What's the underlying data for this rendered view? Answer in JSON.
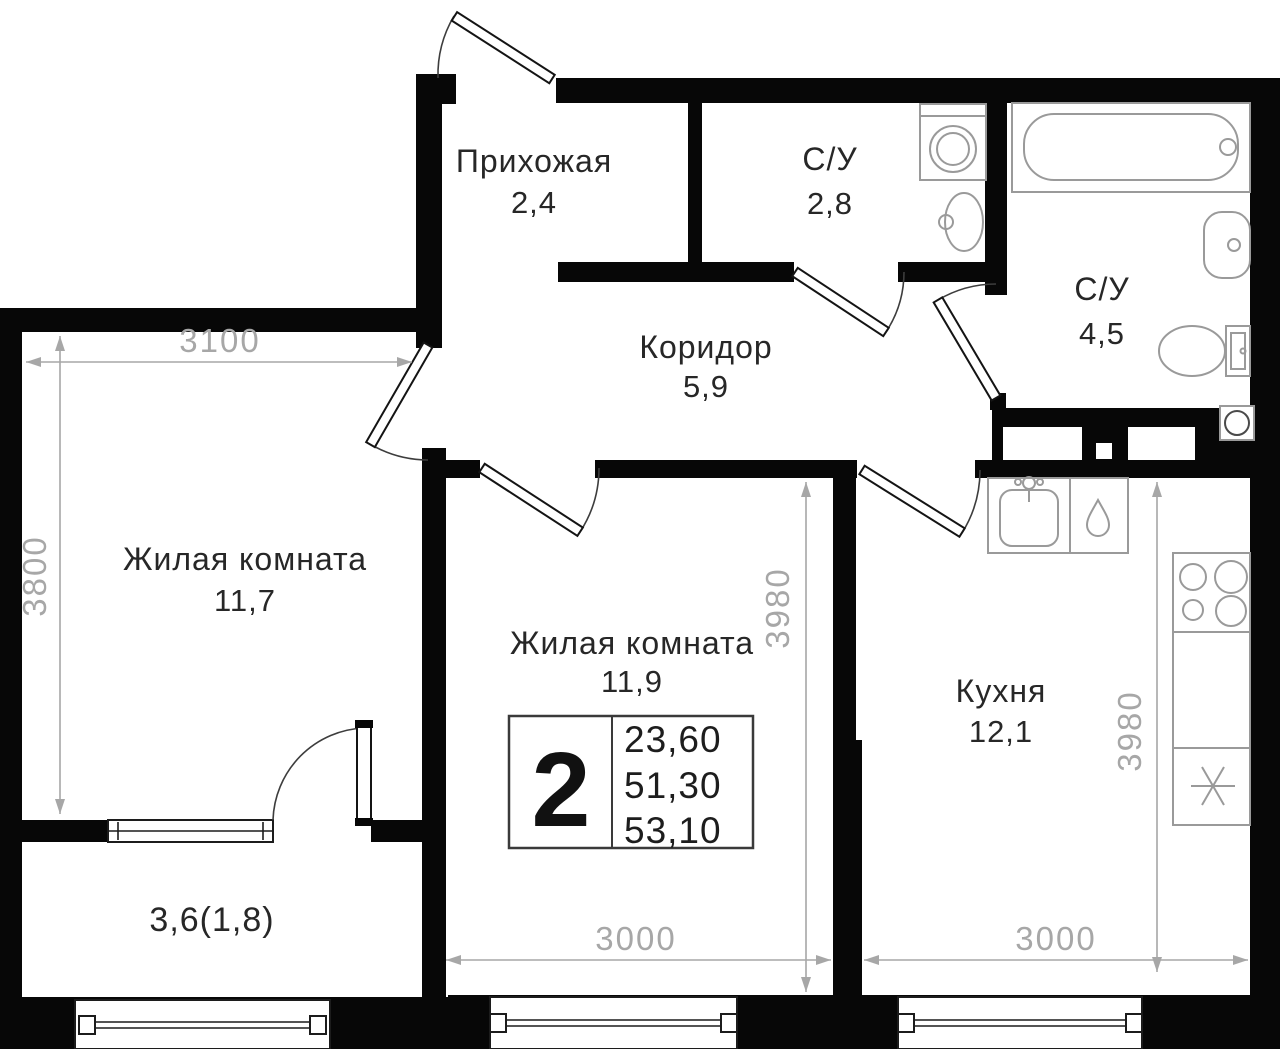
{
  "page": {
    "background": "#ffffff",
    "type": "apartment floor plan"
  },
  "colors": {
    "wall": "#070707",
    "dimension": "#a7a7a7",
    "fixture_stroke": "#9a9a9a",
    "label_text": "#272727"
  },
  "rooms": {
    "hallway": {
      "name": "Прихожая",
      "area": "2,4"
    },
    "wc_small": {
      "name": "С/У",
      "area": "2,8"
    },
    "wc_large": {
      "name": "С/У",
      "area": "4,5"
    },
    "corridor": {
      "name": "Коридор",
      "area": "5,9"
    },
    "living_room_1": {
      "name": "Жилая комната",
      "area": "11,7"
    },
    "living_room_2": {
      "name": "Жилая комната",
      "area": "11,9"
    },
    "kitchen": {
      "name": "Кухня",
      "area": "12,1"
    },
    "balcony": {
      "area_label": "3,6(1,8)"
    }
  },
  "info_box": {
    "rooms_count": "2",
    "living_area": "23,60",
    "apartment_area": "51,30",
    "total_area": "53,10"
  },
  "dimensions": {
    "living1_width": "3100",
    "living1_depth": "3800",
    "living2_width": "3000",
    "living2_depth": "3980",
    "kitchen_width": "3000",
    "kitchen_depth": "3980"
  },
  "fixture_icons": [
    "bathtub-icon",
    "wall-sink-icon",
    "toilet-icon",
    "washing-machine-icon",
    "pedestal-sink-icon",
    "kitchen-sink-icon",
    "faucet-icon",
    "water-drop-icon",
    "cooktop-icon",
    "snowflake-icon",
    "vent-fan-icon",
    "window-icon",
    "door-icon"
  ]
}
